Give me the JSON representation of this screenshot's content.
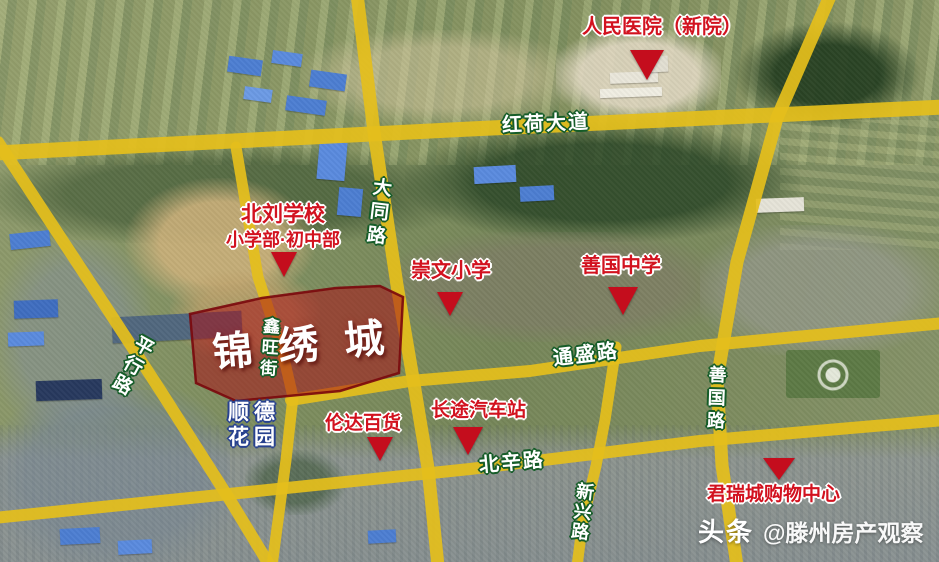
{
  "roads": {
    "honghe_avenue": {
      "label": "红荷大道"
    },
    "datong_road": {
      "label": "大同路"
    },
    "pingxing_road": {
      "label": "平行路"
    },
    "xinwang_street": {
      "label": "鑫旺街"
    },
    "tongsheng_road": {
      "label": "通盛路"
    },
    "beixin_road": {
      "label": "北辛路"
    },
    "xinxing_road": {
      "label": "新兴路"
    },
    "shanguo_road": {
      "label": "善国路"
    }
  },
  "highlight": {
    "name": "锦绣城"
  },
  "pois": {
    "peoples_hospital": {
      "label": "人民医院（新院）"
    },
    "beiliu_school": {
      "name": "北刘学校",
      "detail": "小学部·初中部"
    },
    "chongwen_primary": {
      "label": "崇文小学"
    },
    "shanguo_middle": {
      "label": "善国中学"
    },
    "shunde_garden": {
      "line1": "顺德",
      "line2": "花园"
    },
    "lunda_store": {
      "label": "伦达百货"
    },
    "bus_station": {
      "label": "长途汽车站"
    },
    "junrui_mall": {
      "label": "君瑞城购物中心"
    }
  },
  "watermark": {
    "brand": "头条",
    "account": "@滕州房产观察"
  },
  "colors": {
    "road_yellow": "#e4be1c",
    "marker_red": "#c40d1d",
    "poi_text_red": "#d2121f",
    "highlight_fill": "rgba(167,19,24,0.55)",
    "highlight_stroke": "rgba(122,8,12,0.9)",
    "road_label_outline": "#155c28",
    "blue_label_outline": "#27418f"
  }
}
